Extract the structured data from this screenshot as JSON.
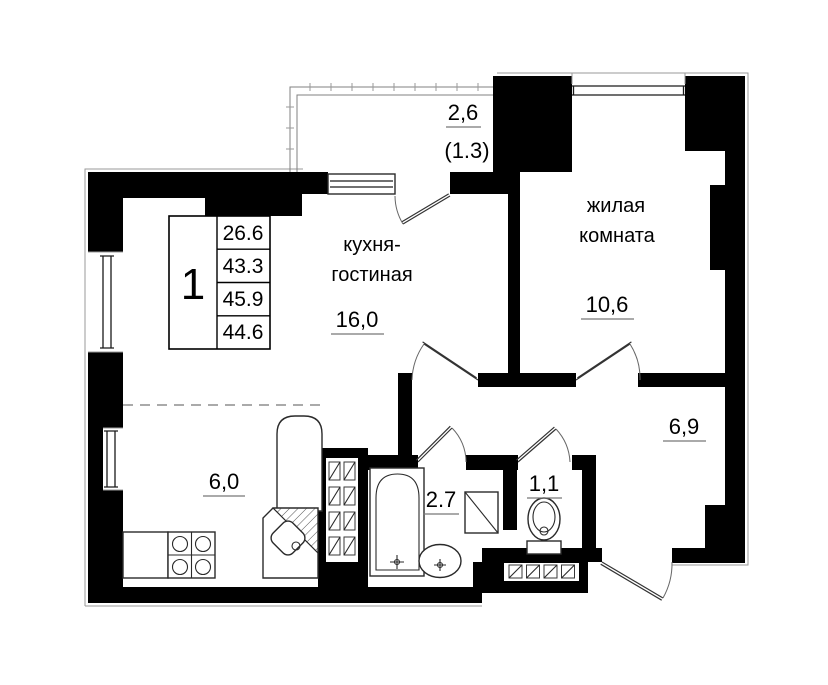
{
  "floor_plan": {
    "type": "apartment-floor-plan",
    "unit_table": {
      "unit_number": "1",
      "areas": [
        "26.6",
        "43.3",
        "45.9",
        "44.6"
      ]
    },
    "rooms": {
      "kitchen_living": {
        "label_line1": "кухня-",
        "label_line2": "гостиная",
        "area": "16,0"
      },
      "living_room": {
        "label_line1": "жилая",
        "label_line2": "комната",
        "area": "10,6"
      },
      "hall": {
        "area": "6,9"
      },
      "bathroom": {
        "area": "2.7"
      },
      "wc": {
        "area": "1,1"
      },
      "kitchen_zone": {
        "area": "6,0"
      },
      "balcony": {
        "area": "2,6",
        "area_reduced": "(1.3)"
      }
    },
    "fixtures": [
      "bathtub",
      "wash-basin",
      "washing-machine",
      "toilet",
      "stove",
      "fridge",
      "corner-sink",
      "kitchen-counter",
      "ventilation-shaft"
    ],
    "colors": {
      "wall": "#000000",
      "line": "#1a1a1a",
      "outline": "#9a9a9a",
      "background": "#ffffff"
    }
  }
}
